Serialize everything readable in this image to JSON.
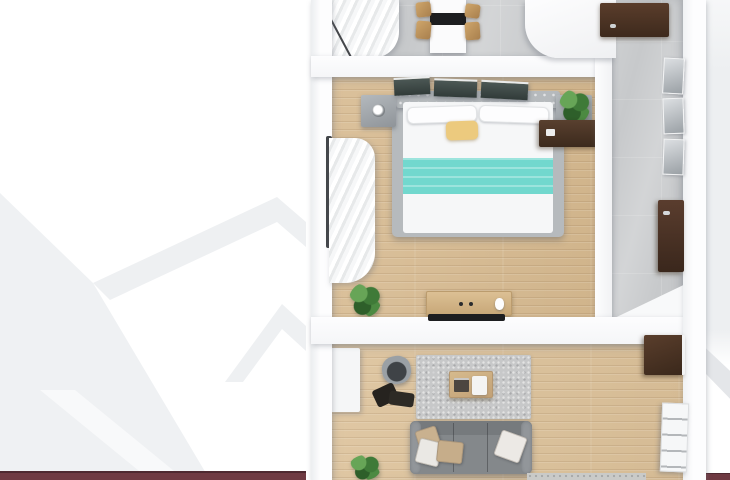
{
  "meta": {
    "kind": "3d-floor-plan-top-down-render",
    "dimensions": {
      "width": 730,
      "height": 480
    },
    "notes": "Photoreal top-down apartment render on white page; faint mountain chevron watermark left; maroon accent bar along bottom edge"
  },
  "palette": {
    "white": "#ffffff",
    "maroon": "#6f3a42",
    "maroon-deep": "#4e2930",
    "watermark": "#eef0f3",
    "bg-right": "#edeff1",
    "tile": "#c7c9cb",
    "wood": "#d7ba90",
    "wood-light": "#dcc199",
    "teal": "#72d8ce",
    "yellow": "#ecca7e",
    "sofa": "#84888b",
    "rug": "#c7c8c9",
    "frame": "#b6babd",
    "black": "#1d1e20"
  },
  "plan": {
    "rooms": [
      {
        "id": "dining-room",
        "floor": "gray-tile",
        "items": [
          "window-curtain",
          "dining-table",
          "black-table-runner",
          "dining-chair x4",
          "white-counter-block",
          "entry-door"
        ]
      },
      {
        "id": "hallway-bathroom",
        "floor": "gray-tile",
        "items": [
          "mirror-panel x3",
          "tall-dark-cabinet"
        ]
      },
      {
        "id": "bedroom",
        "floor": "oak-plank",
        "items": [
          "wall-art-panel x3",
          "tufted-headboard",
          "double-bed-white-duvet",
          "teal-blanket",
          "yellow-throw-pillow",
          "nightstand-with-lamp x2",
          "window-curtains",
          "potted-plant x2",
          "tv-console",
          "tv-soundbar",
          "dark-side-desk"
        ]
      },
      {
        "id": "living-room",
        "floor": "oak-plank",
        "items": [
          "area-rug",
          "coffee-table-with-books-and-tray",
          "bucket-armchair",
          "dark-lounge-throw",
          "gray-sofa",
          "sofa-cushion x4",
          "potted-plant",
          "white-sideboard",
          "dark-wall-cabinet",
          "white-shelf-unit",
          "cut-off-bench"
        ]
      }
    ]
  }
}
